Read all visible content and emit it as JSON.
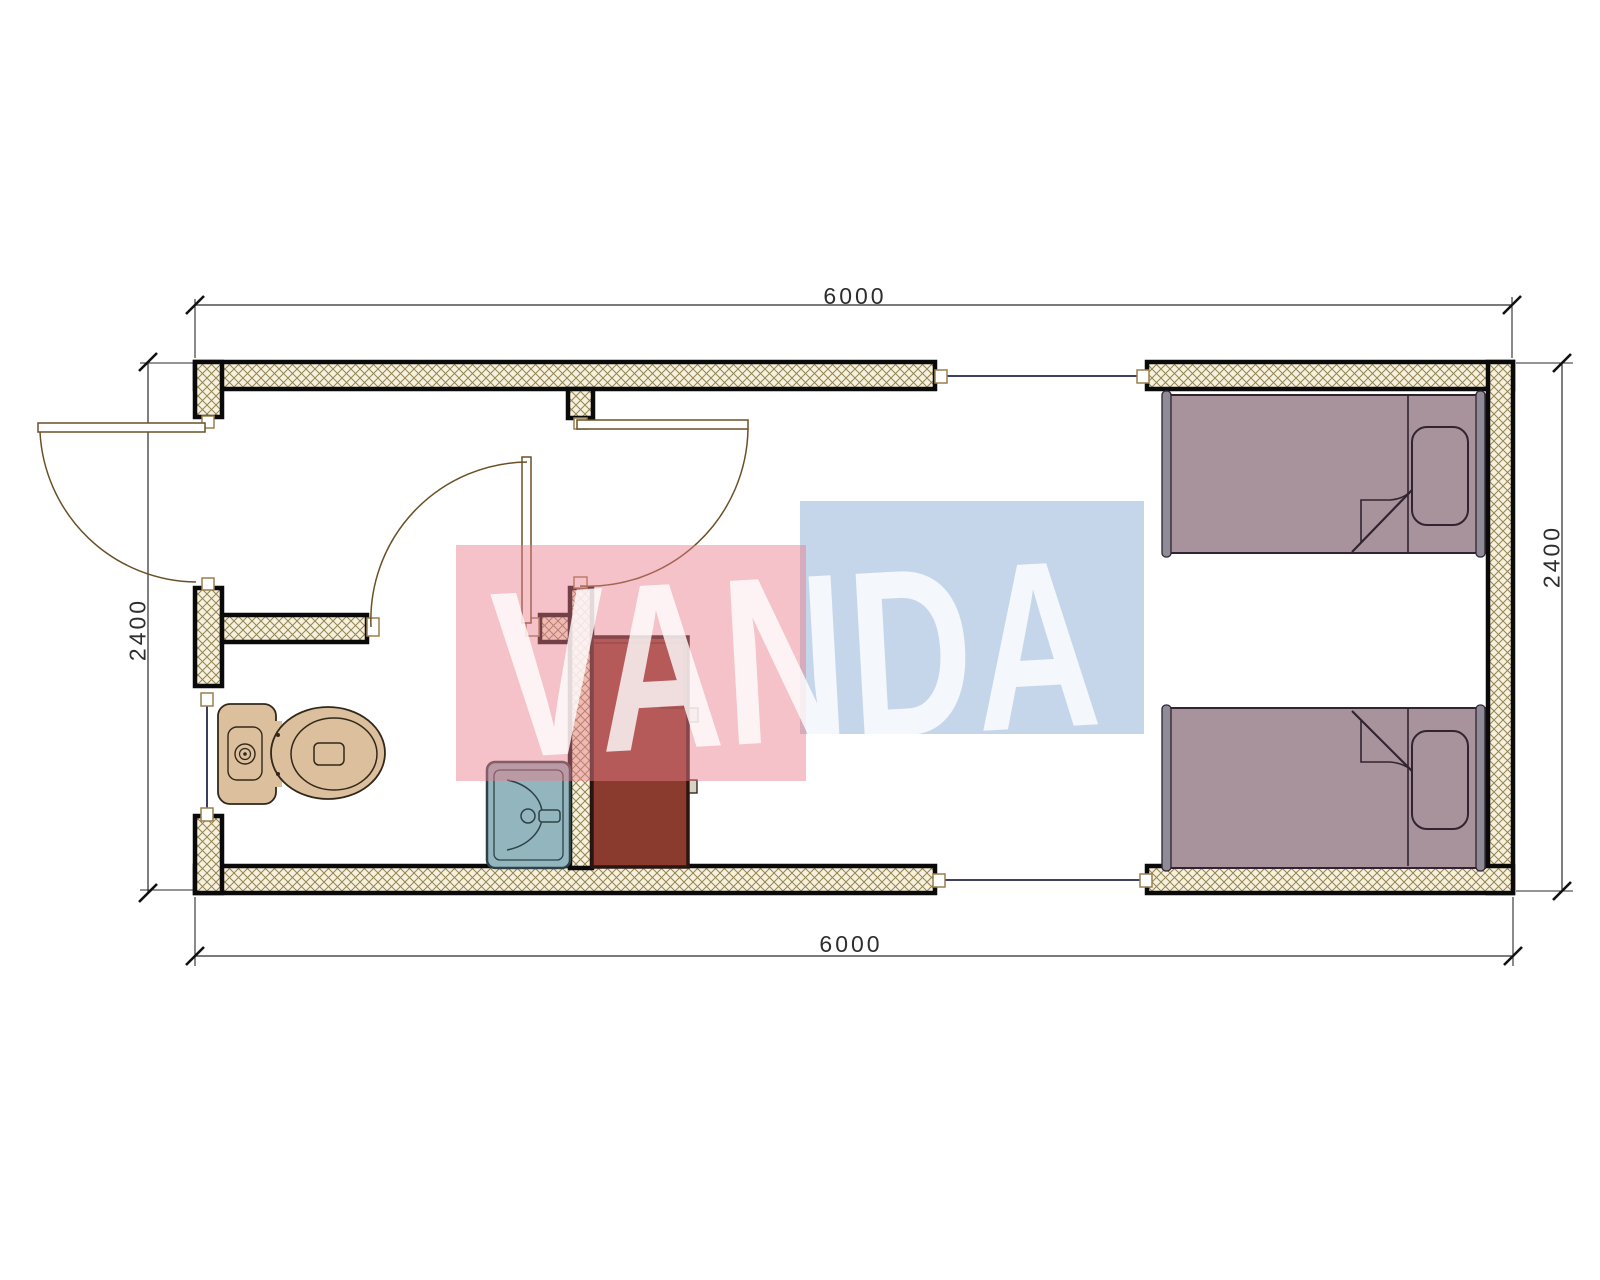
{
  "document": {
    "type": "architectural floor plan",
    "description": "Container cabin plan with bathroom, cabinet and twin-bed room"
  },
  "dimensions": {
    "top": "6000",
    "bottom": "6000",
    "left": "2400",
    "right": "2400"
  },
  "watermark": {
    "text": "VANDA",
    "pink_block_color": "rgba(231,126,139,0.47)",
    "blue_block_color": "rgba(152,180,216,0.55)",
    "text_color": "rgba(255,255,255,0.80)"
  },
  "fixtures": {
    "toilet": "toilet",
    "sink": "wash basin",
    "cabinet": "cabinet",
    "bed_top": "single bed",
    "bed_bottom": "single bed"
  },
  "colors": {
    "wall_hatch_bg": "#f6f0de",
    "wall_hatch_line": "#94854f",
    "wall_outline": "#0a0a0a",
    "door_line": "#6b5026",
    "window_line": "#26264d",
    "toilet_fill": "#dcbf9d",
    "sink_fill": "#92b5be",
    "cabinet_fill": "#8b3b2e",
    "bed_fill": "#a8939c",
    "dimension_line": "#2a2a2a"
  }
}
